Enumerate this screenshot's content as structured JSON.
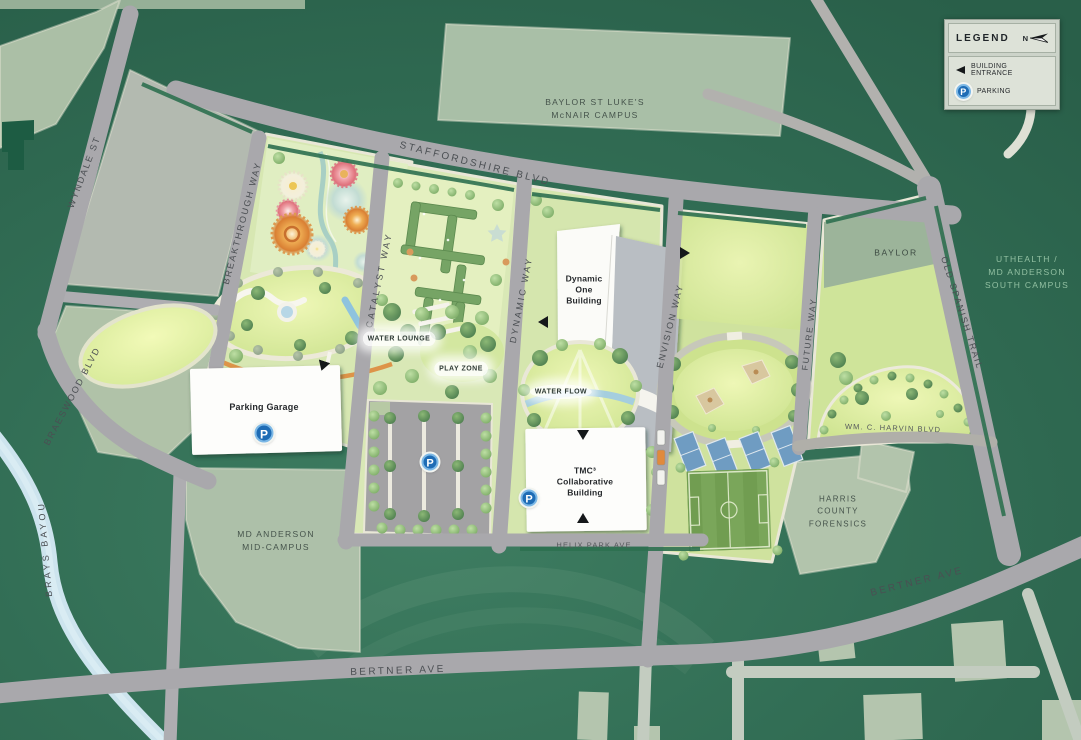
{
  "legend": {
    "title": "LEGEND",
    "north_label": "N",
    "items": [
      {
        "icon": "building-entrance-arrow-icon",
        "label": "BUILDING ENTRANCE"
      },
      {
        "icon": "parking-icon",
        "label": "PARKING"
      }
    ]
  },
  "streets": {
    "staffordshire": "STAFFORDSHIRE BLVD",
    "wyndale": "WYNDALE ST",
    "braeswood": "BRAESWOOD BLVD",
    "brays_bayou": "BRAYS BAYOU",
    "breakthrough": "BREAKTHROUGH WAY",
    "catalyst": "CATALYST WAY",
    "dynamic": "DYNAMIC WAY",
    "envision": "ENVISION WAY",
    "future": "FUTURE WAY",
    "old_spanish_trail": "OLD SPANISH TRAIL",
    "helix_park": "HELIX PARK AVE",
    "harvin": "WM. C. HARVIN BLVD",
    "bertner_south": "BERTNER AVE",
    "bertner_east": "BERTNER AVE"
  },
  "areas": {
    "baylor_st_lukes": {
      "line1": "BAYLOR ST LUKE'S",
      "line2": "McNAIR CAMPUS"
    },
    "uthealth": {
      "line1": "UTHEALTH /",
      "line2": "MD ANDERSON",
      "line3": "SOUTH CAMPUS"
    },
    "md_anderson_mid": {
      "line1": "MD ANDERSON",
      "line2": "MID-CAMPUS"
    },
    "harris_county": {
      "line1": "HARRIS",
      "line2": "COUNTY",
      "line3": "FORENSICS"
    },
    "baylor": {
      "line1": "BAYLOR"
    }
  },
  "buildings": {
    "parking_garage": {
      "line1": "Parking Garage"
    },
    "dynamic_one": {
      "line1": "Dynamic",
      "line2": "One",
      "line3": "Building"
    },
    "tmc3": {
      "line1": "TMC³",
      "line2": "Collaborative",
      "line3": "Building"
    }
  },
  "park_features": {
    "water_lounge": {
      "line1": "WATER",
      "line2": "LOUNGE"
    },
    "play_zone": {
      "line1": "PLAY",
      "line2": "ZONE"
    },
    "water_flow": {
      "line1": "WATER",
      "line2": "FLOW"
    }
  },
  "markers": {
    "parking_symbol": "P"
  },
  "colors": {
    "background": "#2e6b52",
    "road": "#a9a8ac",
    "campus_block": "#abbfa6",
    "park_green": "#d7e7b2",
    "water": "#cde4ee",
    "building_white": "#fdfdfb",
    "parking_blue": "#1e6cb5",
    "accent_orange": "#dd9448"
  }
}
